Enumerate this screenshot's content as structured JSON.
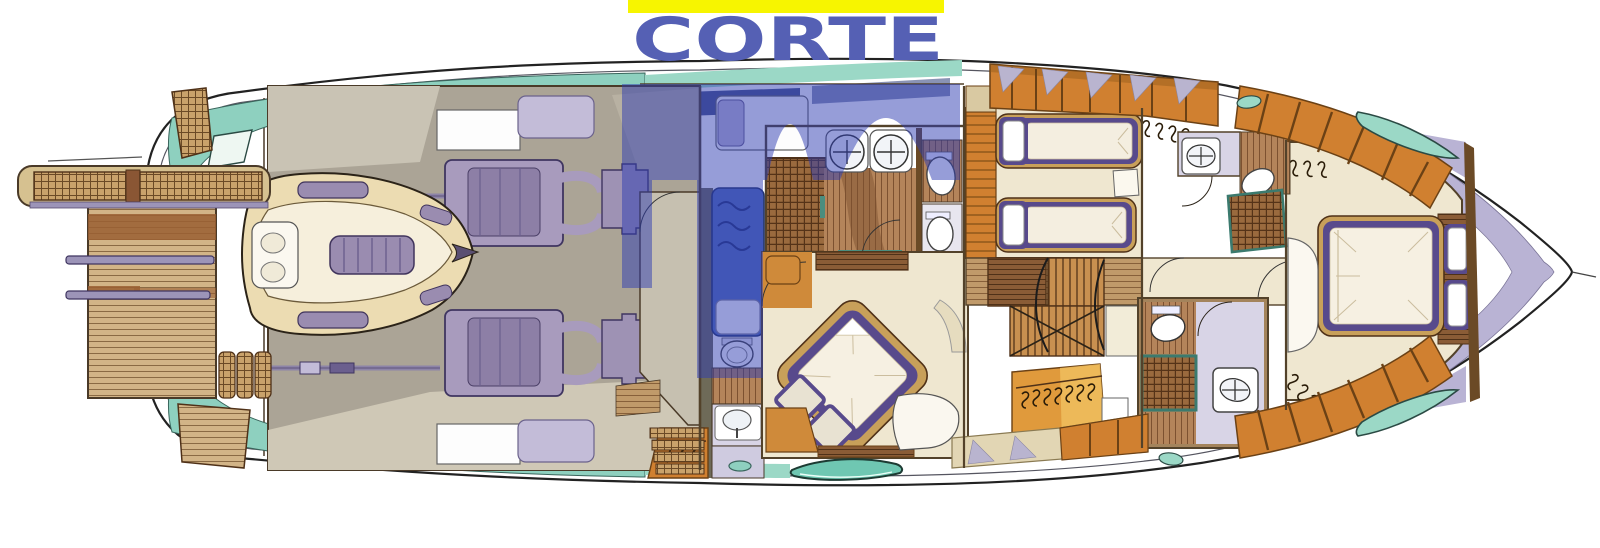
{
  "watermark": {
    "text": "CORTE",
    "underline_color": "#f7f500",
    "text_color": "#5560b4",
    "overlay_color": "#2e3cb2"
  },
  "subject": "yacht-lower-deck-floor-plan",
  "palette": {
    "hull_outline": "#222222",
    "deck_teal": "#8ed0bf",
    "teak": "#d2b487",
    "wood_orange": "#d08030",
    "wood_floor": "#b4845a",
    "dark_wood": "#8a5c36",
    "wall_brown": "#53422a",
    "engine_purple": "#a89bbd",
    "bed_purple": "#584a8c",
    "lavender": "#b9b3d4",
    "cream": "#efe7d0",
    "garage_gray": "#aba496",
    "crew_blue": "#5470bd",
    "navy": "#2a3a77"
  },
  "regions": [
    {
      "name": "passerelle-gangway"
    },
    {
      "name": "swim-platform"
    },
    {
      "name": "tender-garage-engine-room"
    },
    {
      "name": "crew-quarters"
    },
    {
      "name": "master-bathroom"
    },
    {
      "name": "master-cabin"
    },
    {
      "name": "twin-guest-cabin"
    },
    {
      "name": "staircase-lobby"
    },
    {
      "name": "day-head"
    },
    {
      "name": "vip-bow-cabin"
    }
  ]
}
